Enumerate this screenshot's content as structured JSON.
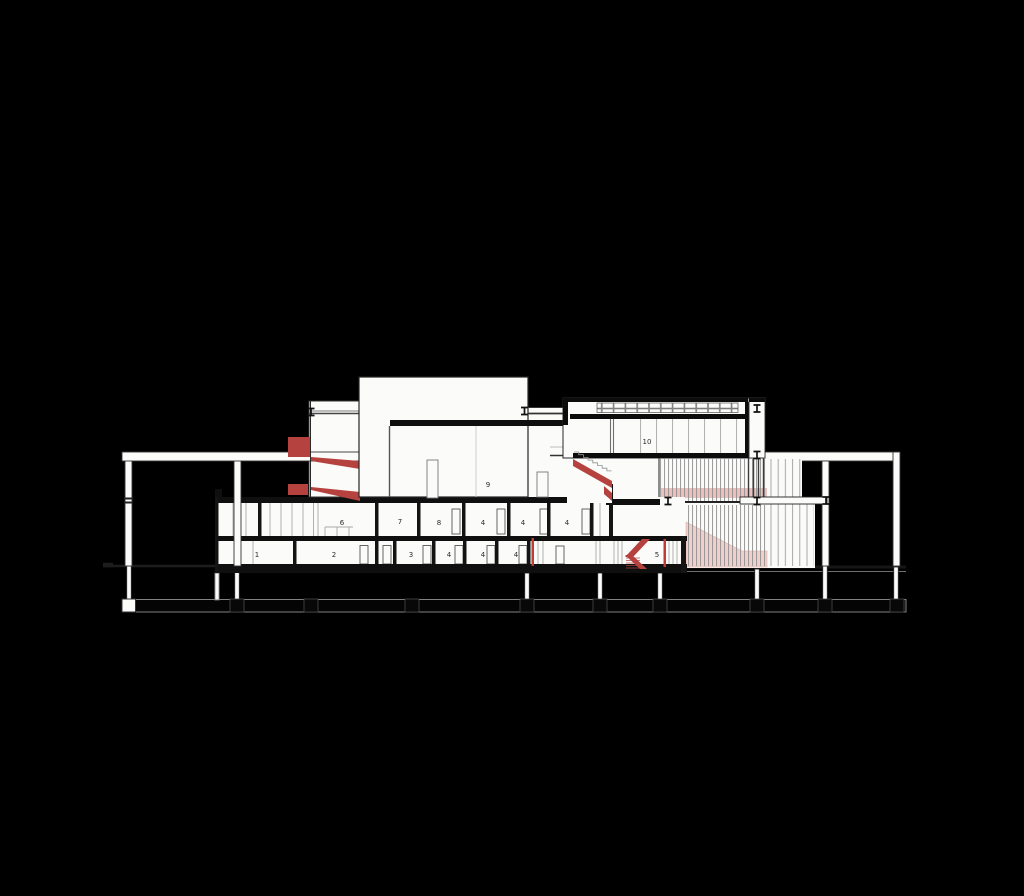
{
  "drawing": {
    "title": "building-longitudinal-section",
    "background": "#000000",
    "colors": {
      "paper": "#fbfbf9",
      "line_dark": "#1a1a1a",
      "line_gray": "#8d8d8d",
      "accent_red": "#b5423e",
      "wash_pink": "#eac1be",
      "wash_pink_light": "#f0d0cc"
    },
    "levels": {
      "lower_level_rooms": [
        "1",
        "2",
        "3",
        "4",
        "4",
        "4",
        "5"
      ],
      "upper_level_rooms": [
        "6",
        "7",
        "8",
        "4",
        "4",
        "4"
      ],
      "main_hall": "9",
      "upper_gallery": "10"
    },
    "labels": [
      {
        "id": "room-1",
        "text": "1"
      },
      {
        "id": "room-2",
        "text": "2"
      },
      {
        "id": "room-3",
        "text": "3"
      },
      {
        "id": "room-4a",
        "text": "4"
      },
      {
        "id": "room-4b",
        "text": "4"
      },
      {
        "id": "room-4c",
        "text": "4"
      },
      {
        "id": "room-5",
        "text": "5"
      },
      {
        "id": "room-6",
        "text": "6"
      },
      {
        "id": "room-7",
        "text": "7"
      },
      {
        "id": "room-8",
        "text": "8"
      },
      {
        "id": "room-4d",
        "text": "4"
      },
      {
        "id": "room-4e",
        "text": "4"
      },
      {
        "id": "room-4f",
        "text": "4"
      },
      {
        "id": "room-9",
        "text": "9"
      },
      {
        "id": "room-10",
        "text": "10"
      }
    ]
  }
}
